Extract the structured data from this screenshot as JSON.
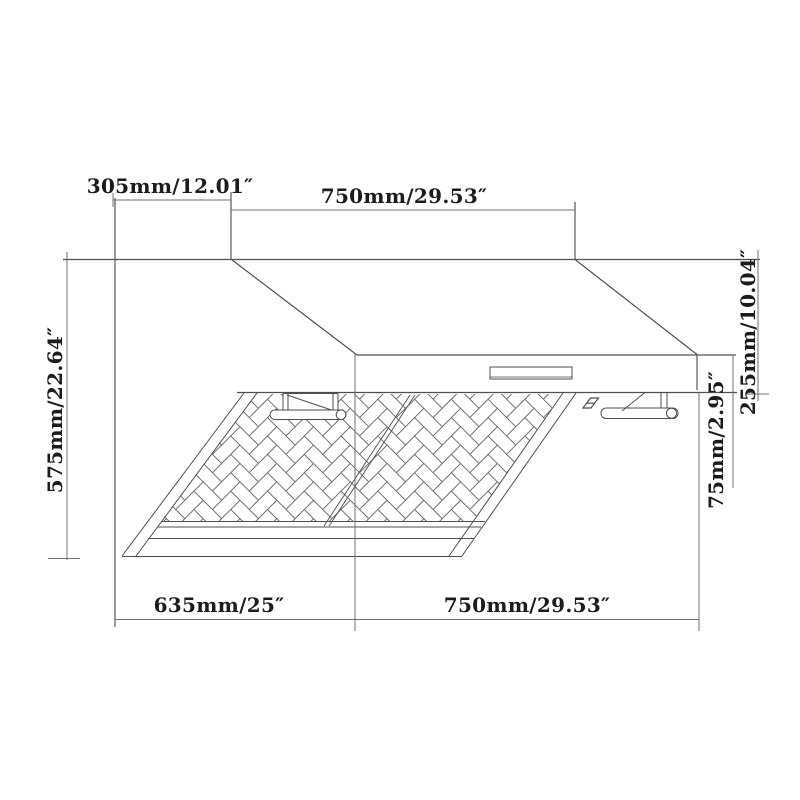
{
  "diagram": {
    "type": "range-hood-dimension-drawing",
    "labels": {
      "top_left": "305mm/12.01″",
      "top_center": "750mm/29.53″",
      "left_side": "575mm/22.64″",
      "right_upper": "255mm/10.04″",
      "right_lower": "75mm/2.95″",
      "bottom_left": "635mm/25″",
      "bottom_right": "750mm/29.53″"
    },
    "colors": {
      "background": "#ffffff",
      "outline": "#4f4f4f",
      "dimension_line": "#707070",
      "filter_line": "#6e6e6e",
      "text": "#1c1c1c"
    }
  }
}
